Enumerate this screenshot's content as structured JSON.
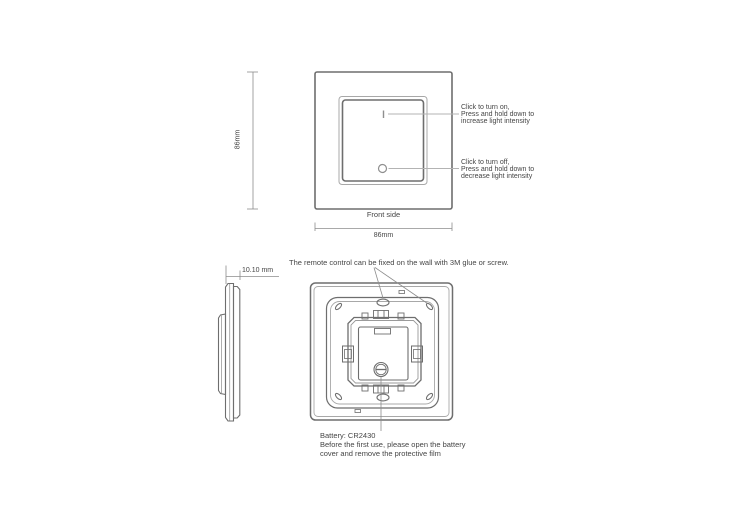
{
  "front_view": {
    "label": "Front side",
    "width_dim": "86mm",
    "height_dim": "86mm",
    "on_note": [
      "Click to turn on,",
      "Press and hold down to",
      "increase light intensity"
    ],
    "off_note": [
      "Click to turn off,",
      "Press and hold down to",
      "decrease light intensity"
    ]
  },
  "side_view": {
    "thickness_dim": "10.10 mm"
  },
  "back_view": {
    "fix_note": "The remote control can be fixed on the wall with 3M glue or screw.",
    "battery_note": [
      "Battery: CR2430",
      "Before the first use, please open the battery",
      "cover and remove the protective film"
    ]
  },
  "colors": {
    "line": "#6e6e6e",
    "line_light": "#a6a6a6",
    "leader": "#8c8c8c",
    "text": "#454545"
  }
}
